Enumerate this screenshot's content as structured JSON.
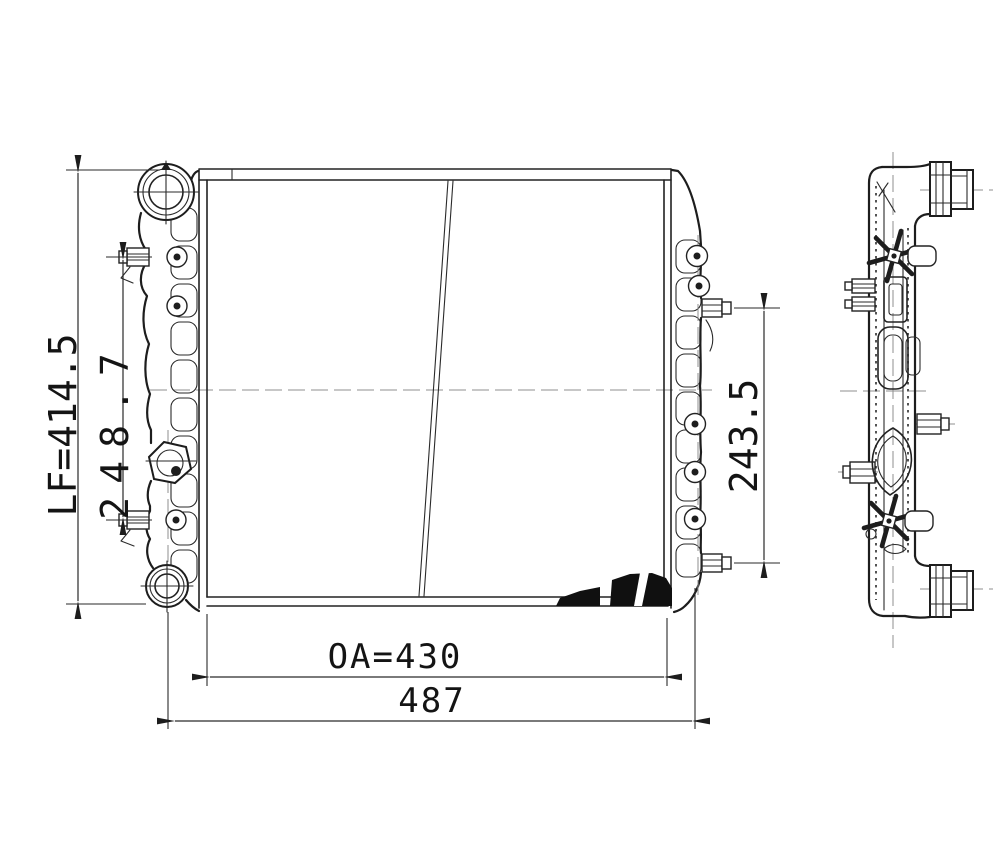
{
  "drawing": {
    "background_color": "#ffffff",
    "ink_color": "#1d1d1d",
    "centerline_color": "#8f8f8f",
    "dimensions": {
      "overall_height": "LF=414.5",
      "left_connector_spacing": "248.7",
      "right_connector_spacing": "243.5",
      "core_width": "OA=430",
      "overall_width": "487"
    }
  }
}
